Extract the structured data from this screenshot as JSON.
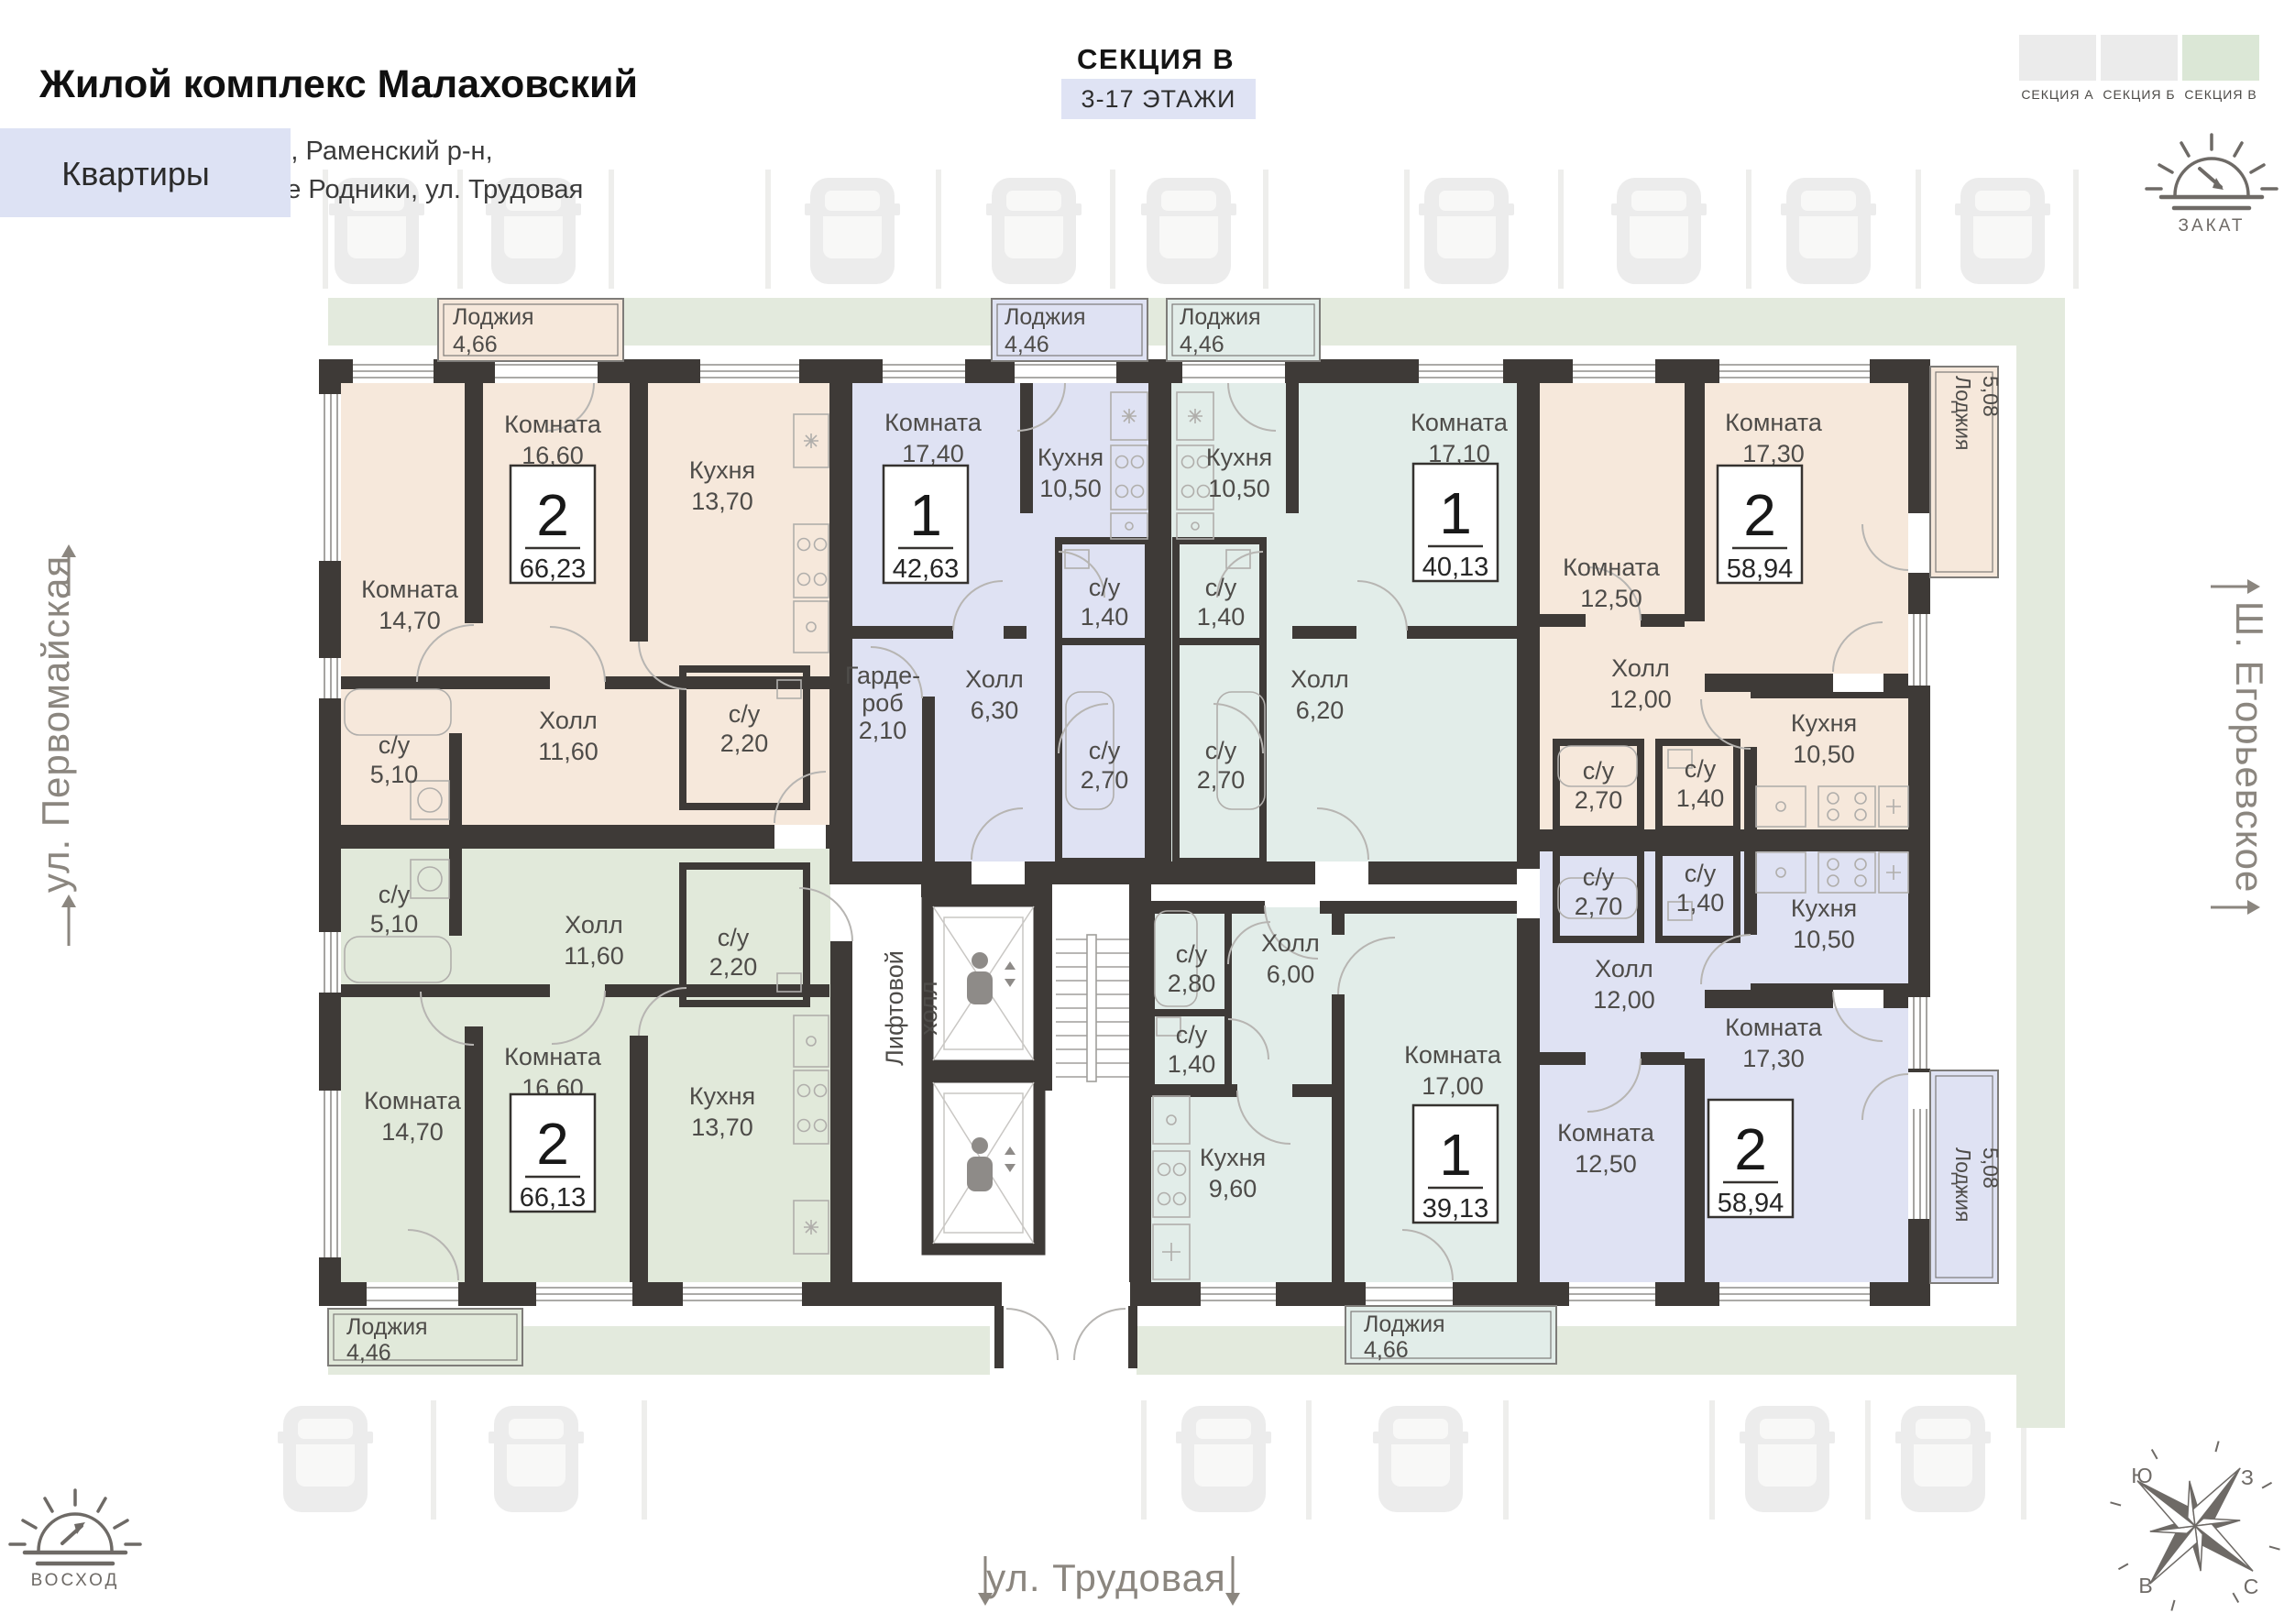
{
  "header": {
    "title": "Жилой комплекс Малаховский",
    "address_line1": "Московская область, Раменский р-н,",
    "address_line2": "городское поселение Родники, ул. Трудовая"
  },
  "section_info": {
    "name": "СЕКЦИЯ В",
    "floors": "3-17 ЭТАЖИ"
  },
  "section_tabs": [
    {
      "label": "СЕКЦИЯ А",
      "active": false
    },
    {
      "label": "СЕКЦИЯ Б",
      "active": false
    },
    {
      "label": "СЕКЦИЯ В",
      "active": true
    }
  ],
  "sidebar": {
    "apartments_label": "Квартиры"
  },
  "orientation": {
    "sunset_label": "ЗАКАТ",
    "sunrise_label": "ВОСХОД"
  },
  "streets": {
    "left": "ул. Первомайская",
    "right": "Ш. Егорьевское",
    "bottom": "ул. Трудовая"
  },
  "compass": {
    "south": "Ю",
    "west": "З",
    "east": "В",
    "north": "С"
  },
  "core": {
    "lift_hall_line1": "Лифтовой",
    "lift_hall_line2": "холл"
  },
  "colors": {
    "peach": "#f6e8db",
    "lavender": "#dfe2f3",
    "teal": "#e2ede9",
    "sage": "#e1e9da",
    "wall": "#3e3a37",
    "site_green": "#e3eadd"
  },
  "apartments": [
    {
      "id": "apt-2-66-23",
      "badge": {
        "rooms": "2",
        "area": "66,23"
      },
      "rooms": [
        {
          "label": "Комната",
          "area": "14,70"
        },
        {
          "label": "Комната",
          "area": "16,60"
        },
        {
          "label": "Кухня",
          "area": "13,70"
        },
        {
          "label": "Холл",
          "area": "11,60"
        },
        {
          "label": "с/у",
          "area": "5,10"
        },
        {
          "label": "с/у",
          "area": "2,20"
        }
      ],
      "loggia": {
        "label": "Лоджия",
        "area": "4,66"
      }
    },
    {
      "id": "apt-1-42-63",
      "badge": {
        "rooms": "1",
        "area": "42,63"
      },
      "rooms": [
        {
          "label": "Комната",
          "area": "17,40"
        },
        {
          "label": "Кухня",
          "area": "10,50"
        },
        {
          "label": "Холл",
          "area": "6,30"
        },
        {
          "label": "Гарде-",
          "label2": "роб",
          "area": "2,10"
        },
        {
          "label": "с/у",
          "area": "1,40"
        },
        {
          "label": "с/у",
          "area": "2,70"
        }
      ],
      "loggia": {
        "label": "Лоджия",
        "area": "4,46"
      }
    },
    {
      "id": "apt-1-40-13",
      "badge": {
        "rooms": "1",
        "area": "40,13"
      },
      "rooms": [
        {
          "label": "Комната",
          "area": "17,10"
        },
        {
          "label": "Кухня",
          "area": "10,50"
        },
        {
          "label": "Холл",
          "area": "6,20"
        },
        {
          "label": "с/у",
          "area": "1,40"
        },
        {
          "label": "с/у",
          "area": "2,70"
        }
      ],
      "loggia": {
        "label": "Лоджия",
        "area": "4,46"
      }
    },
    {
      "id": "apt-2-58-94-top",
      "badge": {
        "rooms": "2",
        "area": "58,94"
      },
      "rooms": [
        {
          "label": "Комната",
          "area": "17,30"
        },
        {
          "label": "Комната",
          "area": "12,50"
        },
        {
          "label": "Кухня",
          "area": "10,50"
        },
        {
          "label": "Холл",
          "area": "12,00"
        },
        {
          "label": "с/у",
          "area": "2,70"
        },
        {
          "label": "с/у",
          "area": "1,40"
        }
      ],
      "loggia": {
        "label": "Лоджия",
        "area": "5,08"
      }
    },
    {
      "id": "apt-2-66-13",
      "badge": {
        "rooms": "2",
        "area": "66,13"
      },
      "rooms": [
        {
          "label": "Комната",
          "area": "14,70"
        },
        {
          "label": "Комната",
          "area": "16,60"
        },
        {
          "label": "Кухня",
          "area": "13,70"
        },
        {
          "label": "Холл",
          "area": "11,60"
        },
        {
          "label": "с/у",
          "area": "5,10"
        },
        {
          "label": "с/у",
          "area": "2,20"
        }
      ],
      "loggia": {
        "label": "Лоджия",
        "area": "4,46"
      }
    },
    {
      "id": "apt-1-39-13",
      "badge": {
        "rooms": "1",
        "area": "39,13"
      },
      "rooms": [
        {
          "label": "Комната",
          "area": "17,00"
        },
        {
          "label": "Кухня",
          "area": "9,60"
        },
        {
          "label": "Холл",
          "area": "6,00"
        },
        {
          "label": "с/у",
          "area": "2,80"
        },
        {
          "label": "с/у",
          "area": "1,40"
        }
      ],
      "loggia": {
        "label": "Лоджия",
        "area": "4,66"
      }
    },
    {
      "id": "apt-2-58-94-bottom",
      "badge": {
        "rooms": "2",
        "area": "58,94"
      },
      "rooms": [
        {
          "label": "Комната",
          "area": "17,30"
        },
        {
          "label": "Комната",
          "area": "12,50"
        },
        {
          "label": "Кухня",
          "area": "10,50"
        },
        {
          "label": "Холл",
          "area": "12,00"
        },
        {
          "label": "с/у",
          "area": "2,70"
        },
        {
          "label": "с/у",
          "area": "1,40"
        }
      ],
      "loggia": {
        "label": "Лоджия",
        "area": "5,08"
      }
    }
  ]
}
